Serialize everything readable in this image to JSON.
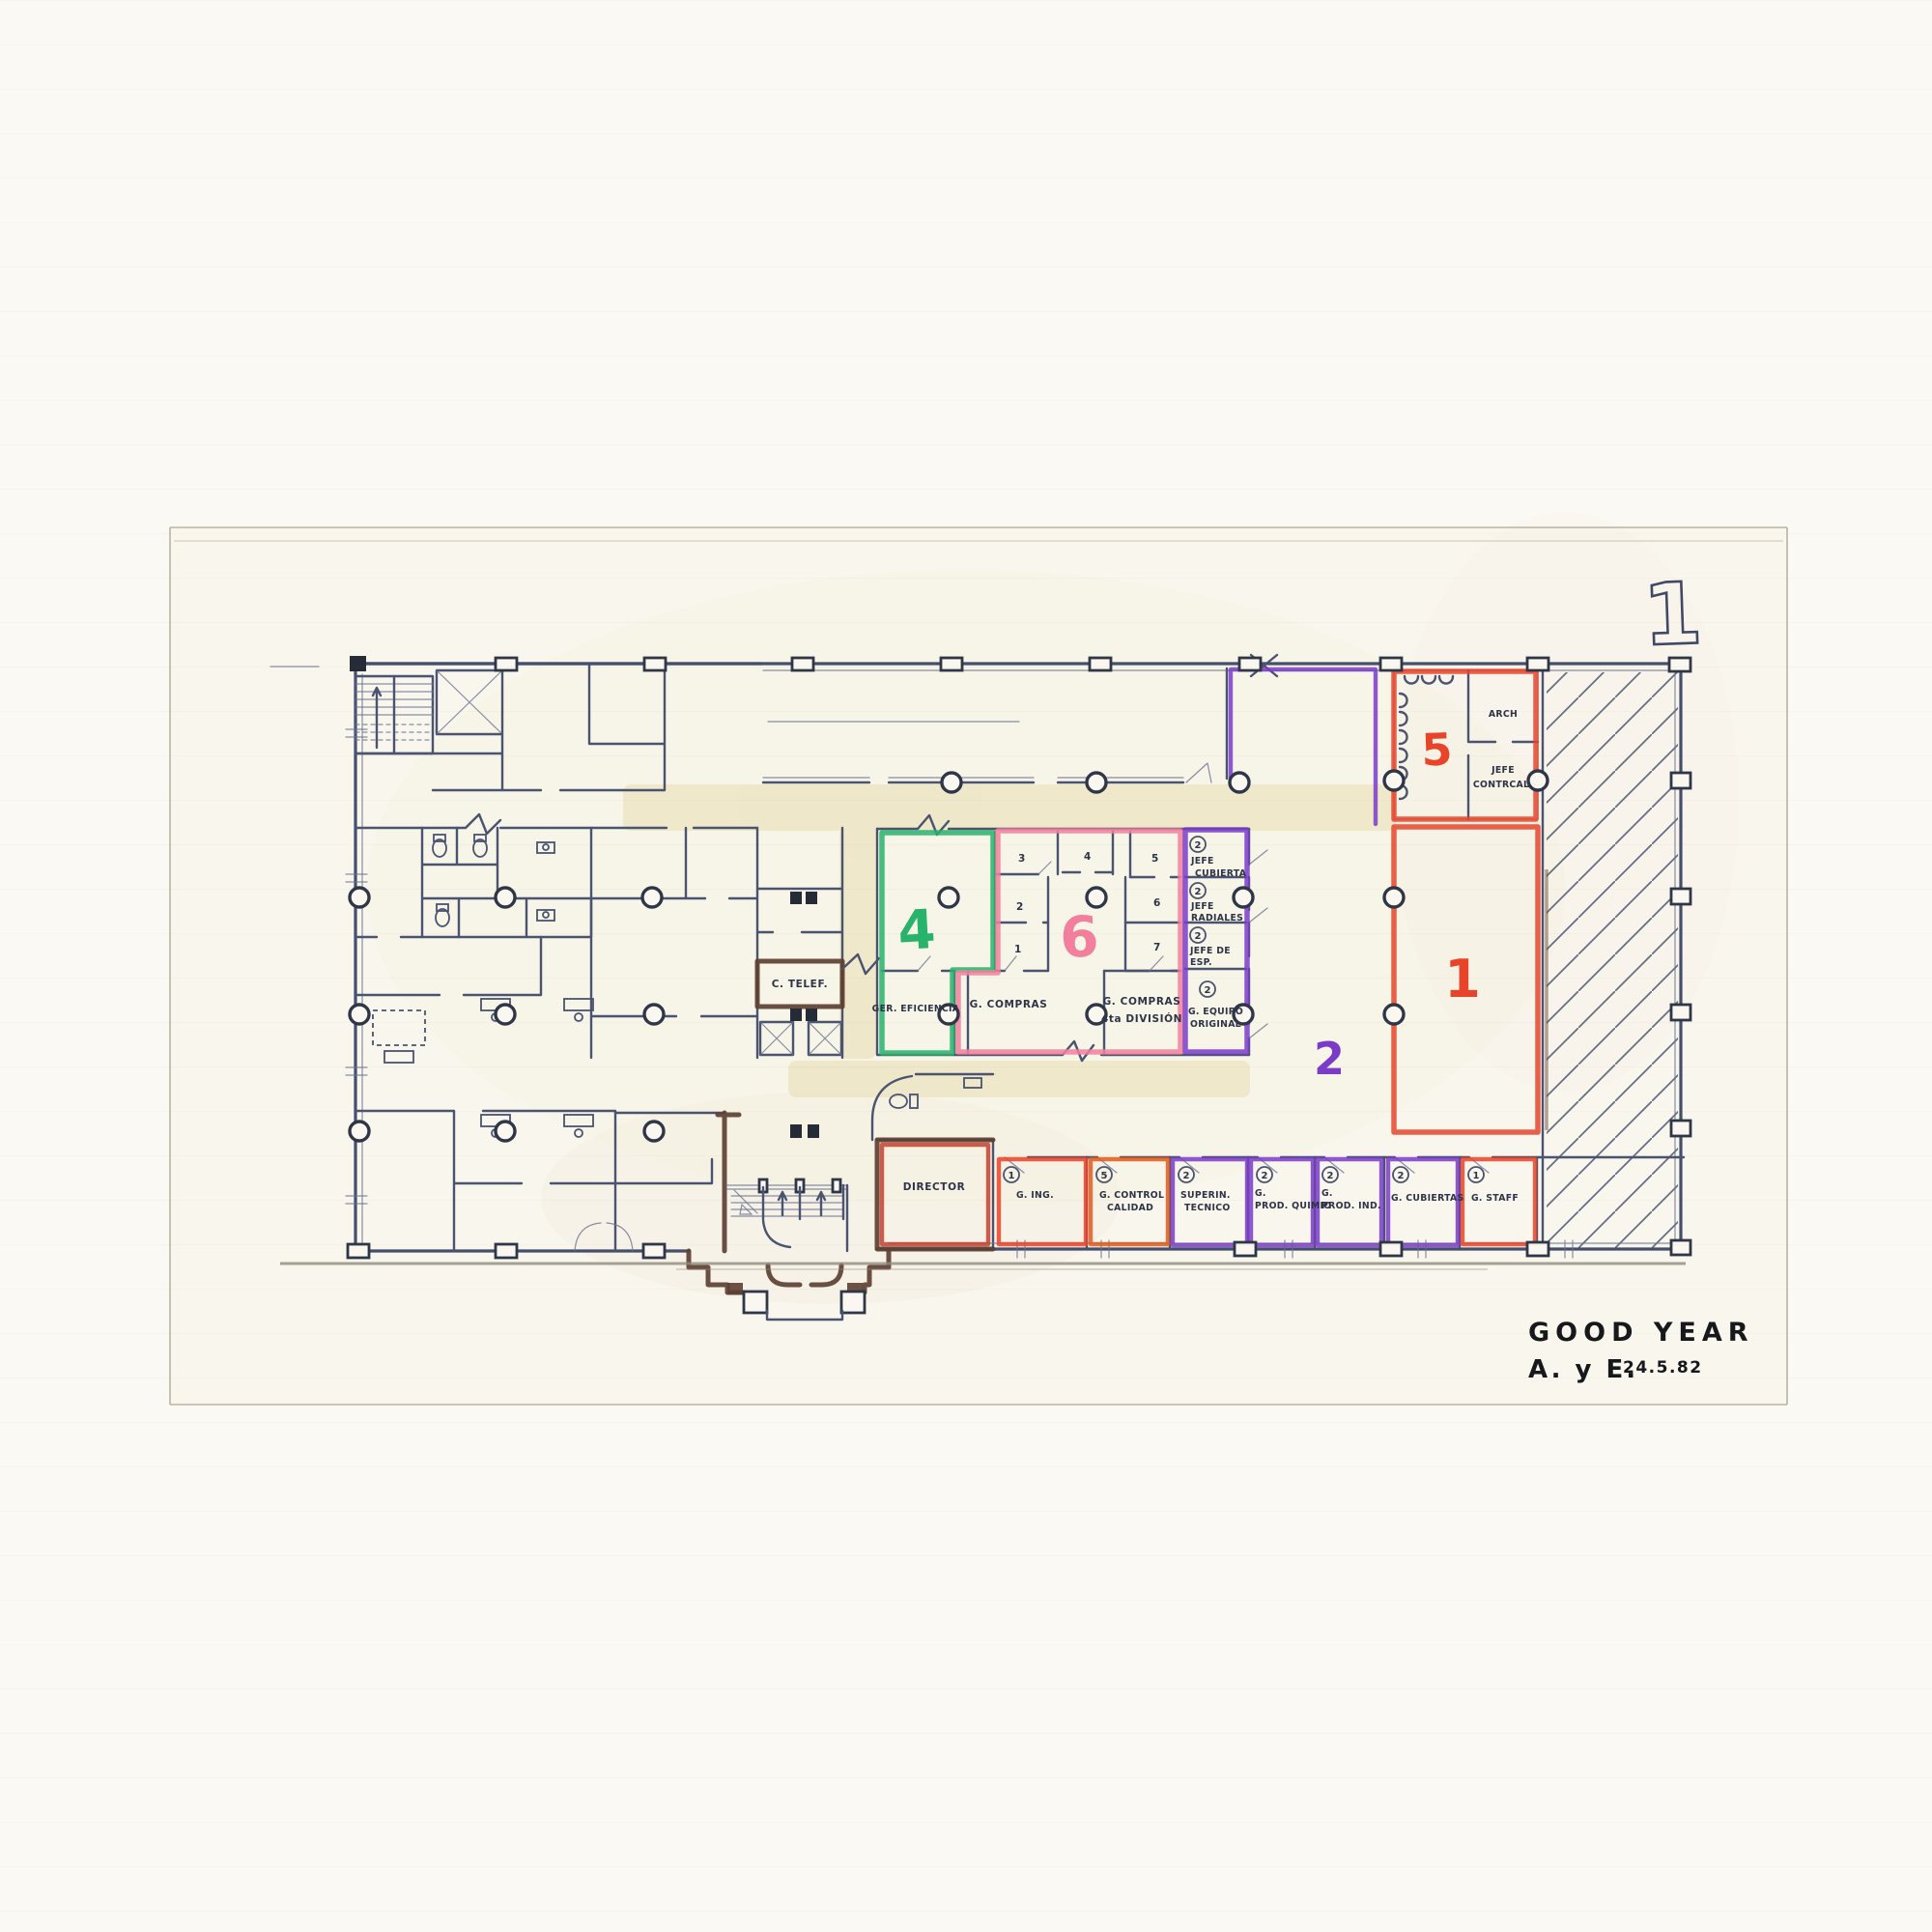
{
  "sheet": {
    "number": "1",
    "title": "GOOD YEAR",
    "subtitle": "A. y E.",
    "date": "24.5.82"
  },
  "colors": {
    "ink": "#4a5370",
    "brown": "#5d4032",
    "red": "#e8442a",
    "dark_red": "#c7402e",
    "orange": "#e05a1c",
    "purple": "#7a3cc8",
    "green": "#27b36b",
    "pink": "#f27f9d",
    "yellow": "#e9dcae"
  },
  "zones": {
    "z1": {
      "label": "1",
      "color": "#e8442a"
    },
    "z2": {
      "label": "2",
      "color": "#7a3cc8"
    },
    "z4": {
      "label": "4",
      "color": "#27b36b"
    },
    "z5": {
      "label": "5",
      "color": "#e8442a"
    },
    "z6": {
      "label": "6",
      "color": "#f27f9d"
    }
  },
  "zone5_rooms": {
    "arch": "ARCH",
    "jefe_line1": "JEFE",
    "jefe_line2": "CONTRCAL."
  },
  "zone6_room_numbers": [
    "1",
    "2",
    "3",
    "4",
    "5",
    "6",
    "7"
  ],
  "central_rooms": {
    "ger_eficiencia": "GER. EFICIENCIA",
    "g_compras": "G. COMPRAS",
    "g_compras_4ta_line1": "G. COMPRAS",
    "g_compras_4ta_line2": "4ta DIVISIÓN",
    "c_telef": "C. TELEF."
  },
  "jefes_column": [
    {
      "badge": "2",
      "line1": "JEFE",
      "line2": "CUBIERTA"
    },
    {
      "badge": "2",
      "line1": "JEFE",
      "line2": "RADIALES"
    },
    {
      "badge": "2",
      "line1": "JEFE DE",
      "line2": "ESP."
    },
    {
      "badge": "2",
      "line1": "G. EQUIPO",
      "line2": "ORIGINAL"
    }
  ],
  "bottom_row": [
    {
      "badge": "",
      "line1": "DIRECTOR",
      "line2": ""
    },
    {
      "badge": "1",
      "line1": "G. ING.",
      "line2": ""
    },
    {
      "badge": "5",
      "line1": "G. CONTROL",
      "line2": "CALIDAD"
    },
    {
      "badge": "2",
      "line1": "SUPERIN.",
      "line2": "TECNICO"
    },
    {
      "badge": "2",
      "line1": "G.",
      "line2": "PROD. QUIMIO"
    },
    {
      "badge": "2",
      "line1": "G.",
      "line2": "PROD. IND."
    },
    {
      "badge": "2",
      "line1": "G. CUBIERTAS",
      "line2": ""
    },
    {
      "badge": "1",
      "line1": "G. STAFF",
      "line2": ""
    }
  ]
}
